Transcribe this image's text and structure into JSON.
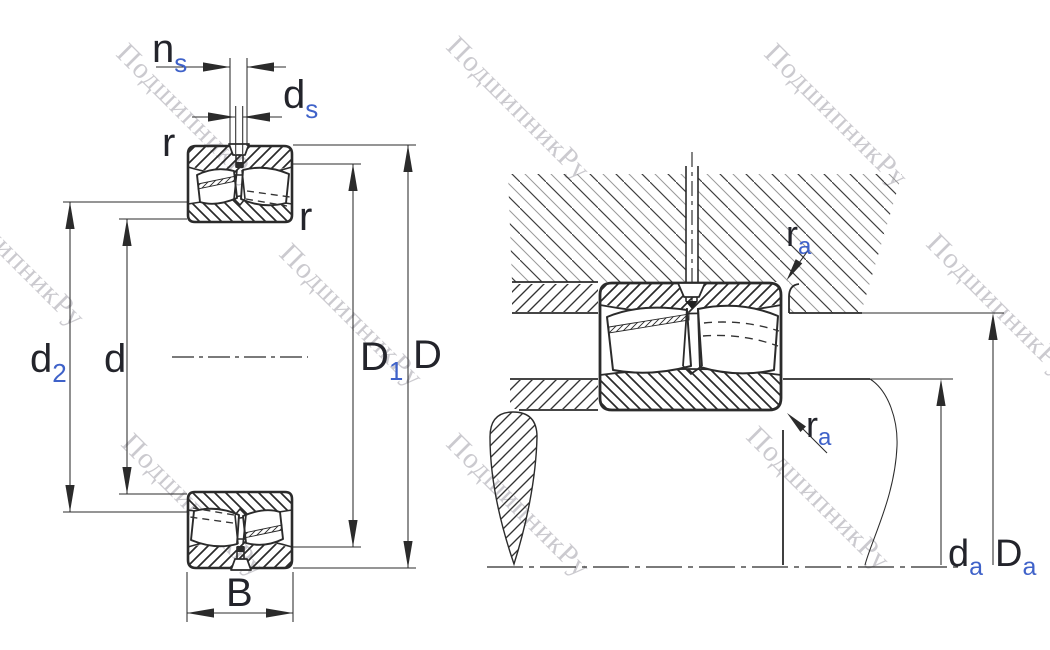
{
  "diagram": {
    "watermark": {
      "text": "ПодшипникРу"
    },
    "labels": {
      "ns": {
        "main": "n",
        "sub": "s"
      },
      "ds": {
        "main": "d",
        "sub": "s"
      },
      "r_top_left": "r",
      "r_top_right": "r",
      "d2": {
        "main": "d",
        "sub": "2"
      },
      "d": "d",
      "D1": {
        "main": "D",
        "sub": "1"
      },
      "D": "D",
      "B": "B",
      "ra_top": {
        "main": "r",
        "sub": "a"
      },
      "ra_bottom": {
        "main": "r",
        "sub": "a"
      },
      "da": {
        "main": "d",
        "sub": "a"
      },
      "Da": {
        "main": "D",
        "sub": "a"
      }
    },
    "colors": {
      "line": "#2b2b2b",
      "label_main": "#23242b",
      "label_sub": "#3f62c9",
      "watermark": "rgba(152,150,160,0.5)"
    }
  }
}
